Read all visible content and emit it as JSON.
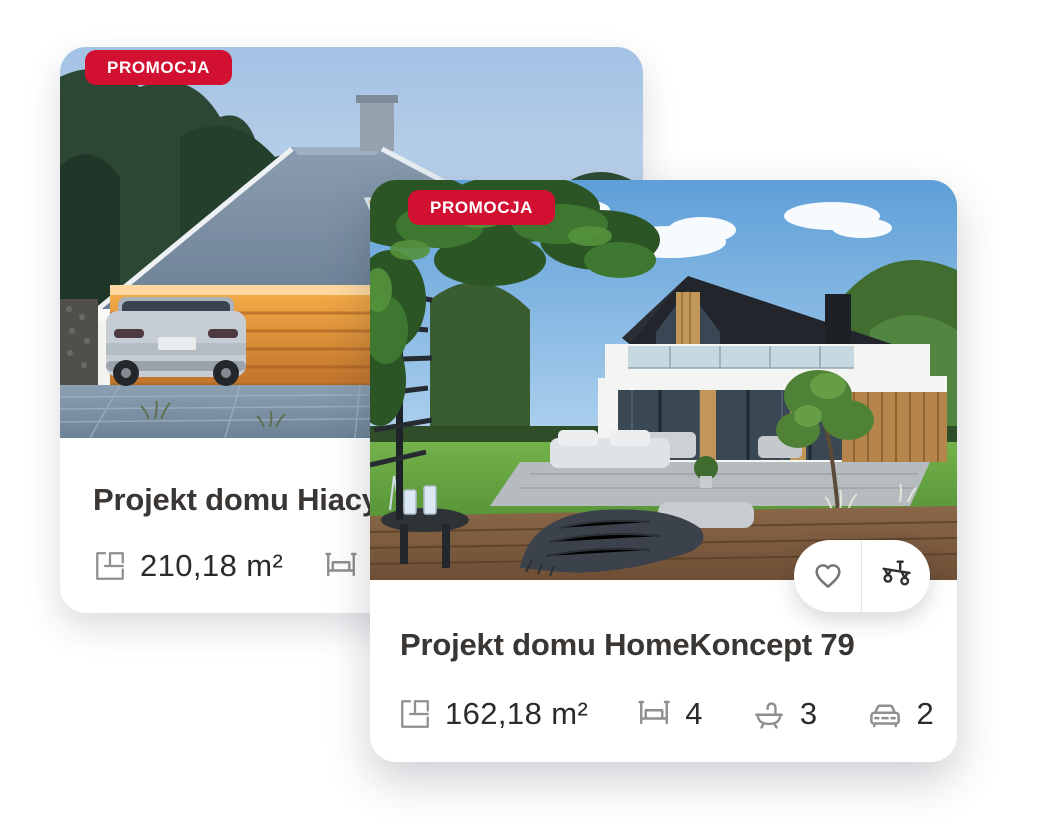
{
  "colors": {
    "page_bg": "#ffffff",
    "badge_bg": "#d21031",
    "badge_text": "#ffffff",
    "card_bg": "#ffffff",
    "title_text": "#3a3633",
    "stat_text": "#2d2a27",
    "stat_icon": "#8f8f8d",
    "action_divider": "#e4e4e4"
  },
  "back_card": {
    "badge_label": "PROMOCJA",
    "title": "Projekt domu Hiacy",
    "stats": {
      "area": {
        "icon": "floor-plan-icon",
        "value": "210,18 m²"
      },
      "beds": {
        "icon": "bed-icon",
        "value": ""
      }
    }
  },
  "front_card": {
    "badge_label": "PROMOCJA",
    "title": "Projekt domu HomeKoncept 79",
    "stats": {
      "area": {
        "icon": "floor-plan-icon",
        "value": "162,18 m²"
      },
      "beds": {
        "icon": "bed-icon",
        "value": "4"
      },
      "baths": {
        "icon": "bath-icon",
        "value": "3"
      },
      "garage": {
        "icon": "car-icon",
        "value": "2"
      }
    },
    "actions": {
      "favorite_icon": "heart-icon",
      "compare_icon": "scale-icon"
    }
  }
}
